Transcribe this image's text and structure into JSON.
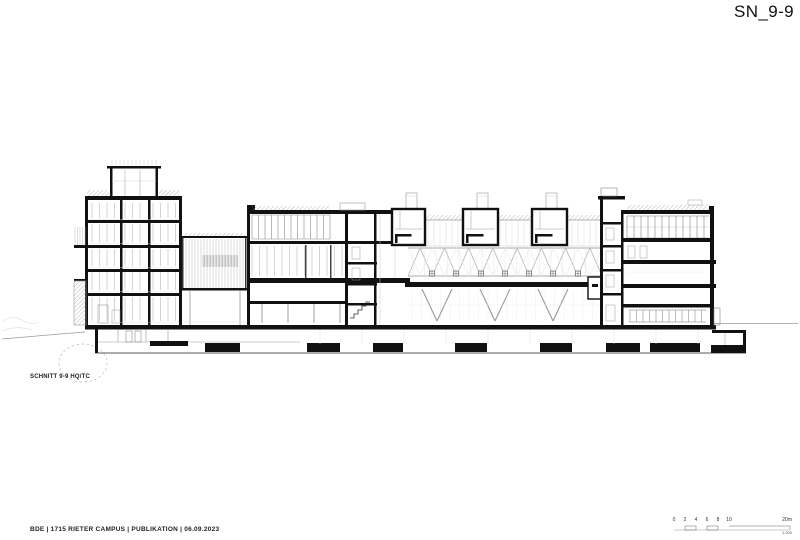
{
  "page": {
    "title": "SN_9-9"
  },
  "drawing": {
    "caption": "SCHNITT 9-9 HQ/TC"
  },
  "footer": {
    "project_info": "BDE | 1715 RIETER CAMPUS | PUBLIKATION | 06.09.2023"
  },
  "scalebar": {
    "ticks": [
      "0",
      "2",
      "4",
      "6",
      "8",
      "10"
    ],
    "max_label": "20m",
    "ratio": "1:200"
  },
  "colors": {
    "ink": "#111111",
    "paper": "#ffffff",
    "line_medium": "#777777",
    "line_light": "#bbbbbb"
  }
}
